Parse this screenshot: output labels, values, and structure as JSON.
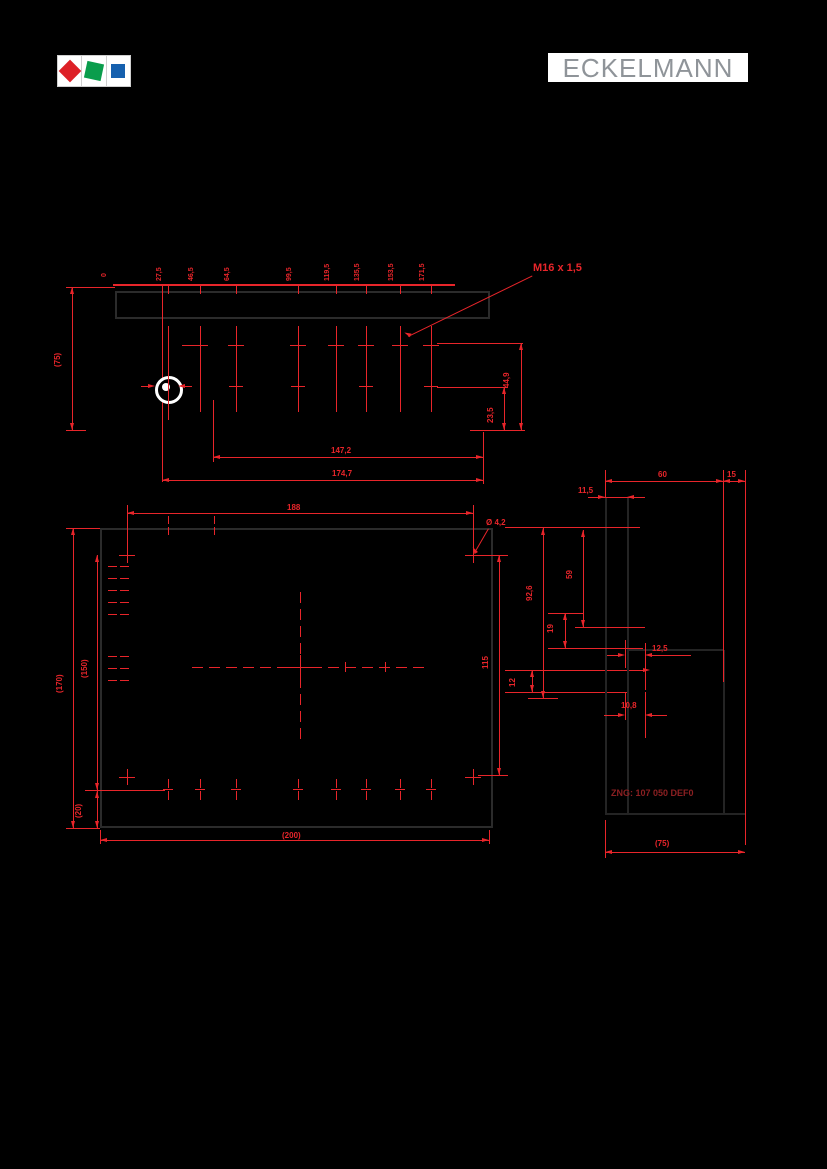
{
  "header": {
    "brand": "ECKELMANN",
    "logo_colors": {
      "red": "#dd2026",
      "green": "#0a9d4c",
      "blue": "#1660ae"
    }
  },
  "colors": {
    "background": "#000000",
    "dimension": "#e8252a",
    "outline": "#2b2b2b",
    "note": "#8c2022"
  },
  "top_view": {
    "origin_label": "0",
    "gland_positions": [
      "27,5",
      "46,5",
      "64,5",
      "99,5",
      "119,5",
      "135,5",
      "153,5",
      "171,5"
    ],
    "thread_label": "M16 x 1,5",
    "dim_height_left": "(75)",
    "dim_row_a": "44,9",
    "dim_row_b": "23,5",
    "dim_width_inner": "147,2",
    "dim_width_outer": "174,7"
  },
  "front_view": {
    "dim_width_holes": "188",
    "hole_diameter": "Ø 4,2",
    "dim_height_outer": "(170)",
    "dim_height_inner": "(150)",
    "dim_height_right": "115",
    "dim_width_outer": "(200)",
    "dim_bottom_left": "(20)",
    "dim_small_right": "12"
  },
  "side_view": {
    "dim_top": "60",
    "dim_top_right": "15",
    "dim_offset": "11,5",
    "dim_h1": "92,6",
    "dim_h2": "59",
    "dim_h3": "19",
    "dim_w1": "12,5",
    "dim_w2": "10,8",
    "dim_depth": "(75)",
    "drawing_note": "ZNG: 107 050 DEF0"
  }
}
